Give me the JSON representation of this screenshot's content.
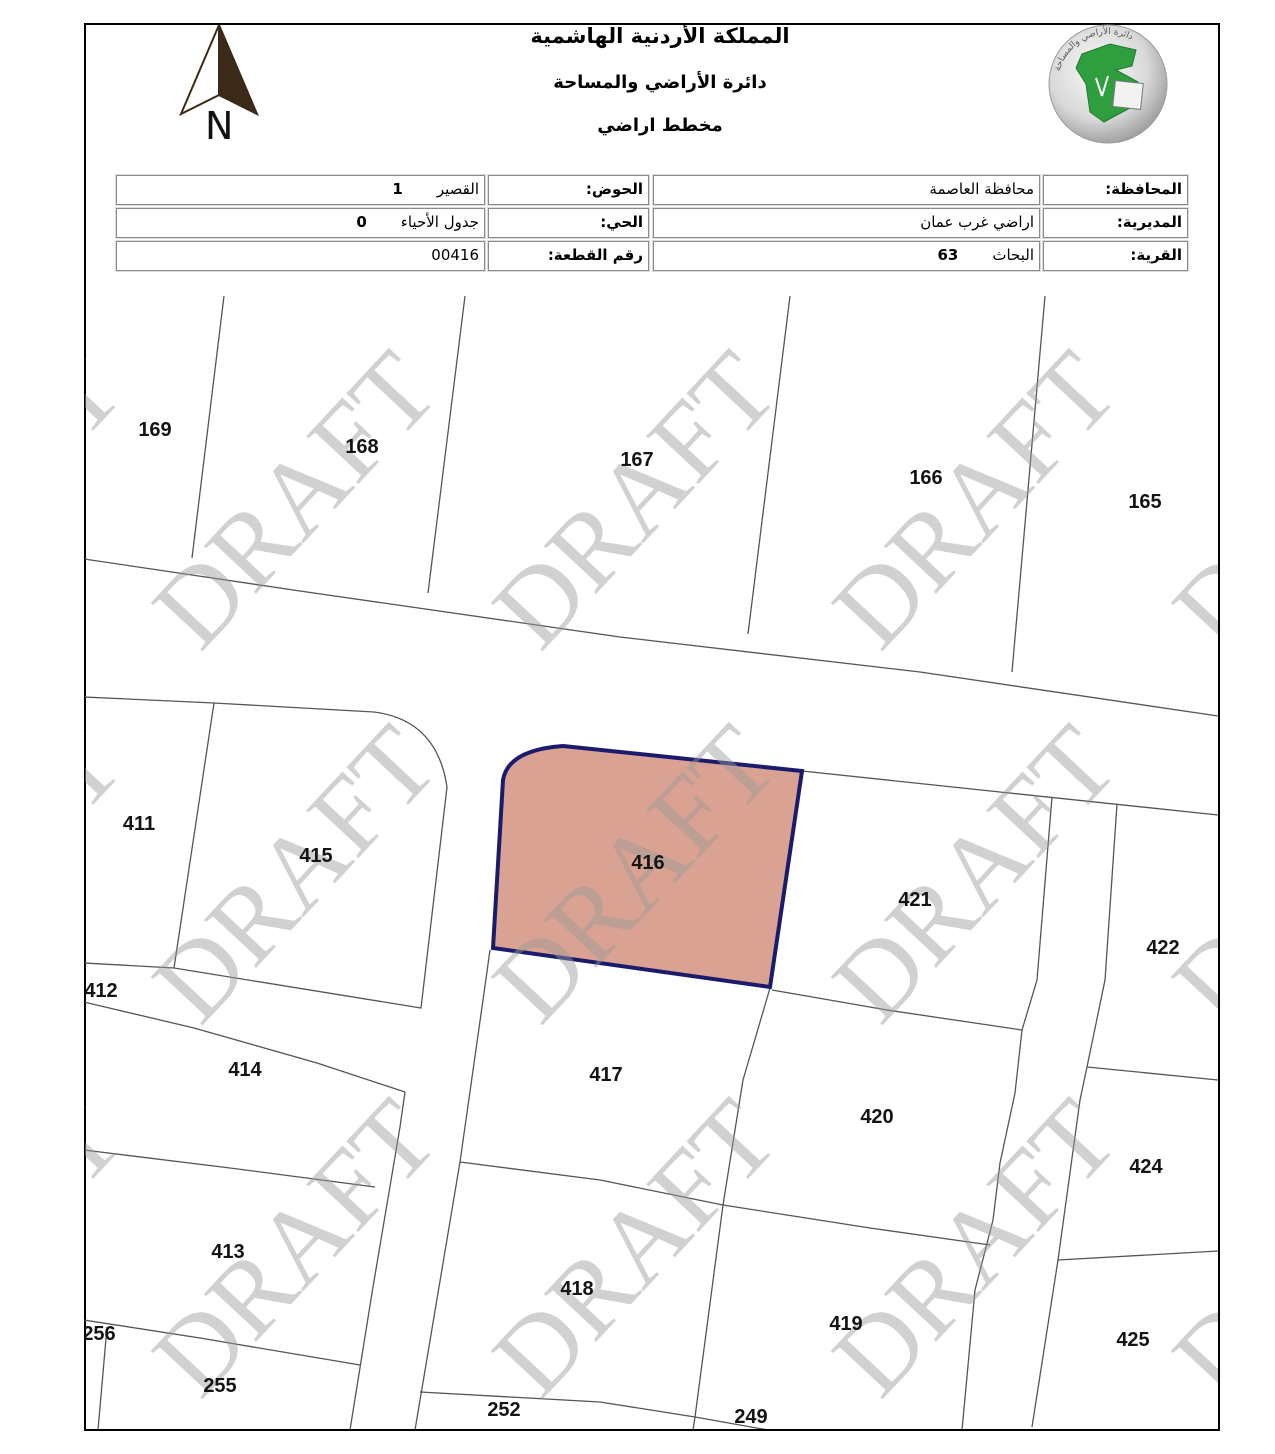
{
  "header": {
    "title1": "المملكة الأردنية الهاشمية",
    "title2": "دائرة الأراضي والمساحة",
    "title3": "مخطط اراضي"
  },
  "compass": {
    "label": "N"
  },
  "logo_alt": "دائرة الأراضي والمساحة",
  "info_table": {
    "rows": [
      {
        "right_label": "المحافظة:",
        "right_value": "محافظة العاصمة",
        "right_num": "",
        "left_label": "الحوض:",
        "left_value": "القصير",
        "left_num": "1"
      },
      {
        "right_label": "المديرية:",
        "right_value": "اراضي غرب عمان",
        "right_num": "",
        "left_label": "الحي:",
        "left_value": "جدول الأحياء",
        "left_num": "0"
      },
      {
        "right_label": "القرية:",
        "right_value": "البحاث",
        "right_num": "63",
        "left_label": "رقم القطعة:",
        "left_value": "00416",
        "left_num": ""
      }
    ]
  },
  "map": {
    "highlighted_plot": "416",
    "highlight_fill": "#d9a292",
    "highlight_border": "#1b1b6e",
    "line_color": "#555555",
    "watermark": {
      "text": "DRAFT",
      "color": "#9a9a9a",
      "opacity": 0.45,
      "angle": -47,
      "cols": [
        -20,
        295,
        635,
        975,
        1315
      ],
      "rows": [
        500,
        874,
        1248
      ]
    },
    "plots": [
      {
        "id": "169",
        "x": 155,
        "y": 430
      },
      {
        "id": "168",
        "x": 362,
        "y": 447
      },
      {
        "id": "167",
        "x": 637,
        "y": 460
      },
      {
        "id": "166",
        "x": 926,
        "y": 478
      },
      {
        "id": "165",
        "x": 1145,
        "y": 502
      },
      {
        "id": "411",
        "x": 139,
        "y": 824
      },
      {
        "id": "415",
        "x": 316,
        "y": 856
      },
      {
        "id": "416",
        "x": 648,
        "y": 863
      },
      {
        "id": "421",
        "x": 915,
        "y": 900
      },
      {
        "id": "422",
        "x": 1163,
        "y": 948
      },
      {
        "id": "412",
        "x": 101,
        "y": 991
      },
      {
        "id": "414",
        "x": 245,
        "y": 1070
      },
      {
        "id": "417",
        "x": 606,
        "y": 1075
      },
      {
        "id": "420",
        "x": 877,
        "y": 1117
      },
      {
        "id": "424",
        "x": 1146,
        "y": 1167
      },
      {
        "id": "413",
        "x": 228,
        "y": 1252
      },
      {
        "id": "418",
        "x": 577,
        "y": 1289
      },
      {
        "id": "419",
        "x": 846,
        "y": 1324
      },
      {
        "id": "425",
        "x": 1133,
        "y": 1340
      },
      {
        "id": "256",
        "x": 99,
        "y": 1334
      },
      {
        "id": "255",
        "x": 220,
        "y": 1386
      },
      {
        "id": "252",
        "x": 504,
        "y": 1410
      },
      {
        "id": "249",
        "x": 751,
        "y": 1417
      }
    ]
  }
}
